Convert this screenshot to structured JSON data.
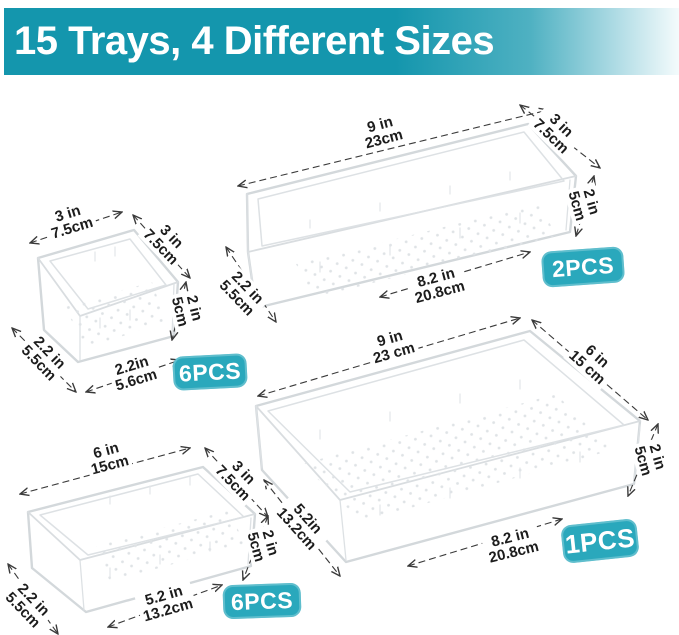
{
  "header": {
    "title": "15 Trays, 4 Different Sizes"
  },
  "colors": {
    "banner_teal": "#1496ad",
    "badge_teal": "#2aa8bc"
  },
  "trays": [
    {
      "name": "small square tray",
      "badge": "6PCS",
      "dims": {
        "top": {
          "in": "3 in",
          "cm": "7.5cm"
        },
        "side": {
          "in": "3 in",
          "cm": "7.5cm"
        },
        "height": {
          "in": "2 in",
          "cm": "5cm"
        },
        "inner_side": {
          "in": "2.2 in",
          "cm": "5.5cm"
        },
        "inner_width": {
          "in": "2.2in",
          "cm": "5.6cm"
        }
      }
    },
    {
      "name": "long narrow tray",
      "badge": "2PCS",
      "dims": {
        "top": {
          "in": "9 in",
          "cm": "23cm"
        },
        "side": {
          "in": "3 in",
          "cm": "7.5cm"
        },
        "height": {
          "in": "2 in",
          "cm": "5cm"
        },
        "inner_side": {
          "in": "2.2 in",
          "cm": "5.5cm"
        },
        "inner_width": {
          "in": "8.2 in",
          "cm": "20.8cm"
        }
      }
    },
    {
      "name": "medium tray",
      "badge": "6PCS",
      "dims": {
        "top": {
          "in": "6 in",
          "cm": "15cm"
        },
        "side": {
          "in": "3 in",
          "cm": "7.5cm"
        },
        "height": {
          "in": "2 in",
          "cm": "5cm"
        },
        "inner_side": {
          "in": "2.2 in",
          "cm": "5.5cm"
        },
        "inner_width": {
          "in": "5.2 in",
          "cm": "13.2cm"
        }
      }
    },
    {
      "name": "large tray",
      "badge": "1PCS",
      "dims": {
        "top": {
          "in": "9 in",
          "cm": "23 cm"
        },
        "side": {
          "in": "6 in",
          "cm": "15 cm"
        },
        "height": {
          "in": "2 in",
          "cm": "5cm"
        },
        "inner_side": {
          "in": "5.2in",
          "cm": "13.2cm"
        },
        "inner_width": {
          "in": "8.2 in",
          "cm": "20.8cm"
        }
      }
    }
  ]
}
